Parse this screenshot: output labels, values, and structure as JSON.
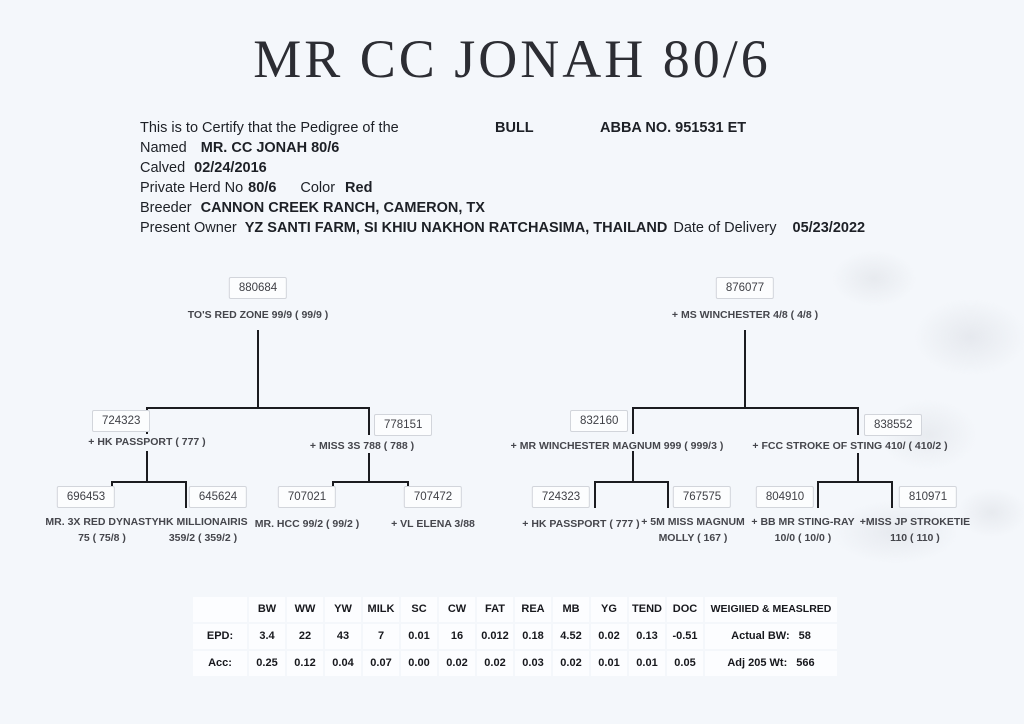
{
  "title": "MR CC JONAH 80/6",
  "certificate": {
    "intro": "This is to Certify that the Pedigree of the",
    "animal_type": "BULL",
    "abba_no": "ABBA NO. 951531 ET",
    "named_label": "Named",
    "named_value": "MR. CC JONAH 80/6",
    "calved_label": "Calved",
    "calved_value": "02/24/2016",
    "herd_label": "Private Herd No",
    "herd_value": "80/6",
    "color_label": "Color",
    "color_value": "Red",
    "breeder_label": "Breeder",
    "breeder_value": "CANNON CREEK RANCH, CAMERON, TX",
    "owner_label": "Present Owner",
    "owner_value": "YZ SANTI FARM, SI KHIU NAKHON RATCHASIMA, THAILAND",
    "delivery_label": "Date of Delivery",
    "delivery_value": "05/23/2022"
  },
  "ped": {
    "s": {
      "reg": "880684",
      "name": "TO'S RED ZONE 99/9 ( 99/9 )"
    },
    "ss": {
      "reg": "724323",
      "name": "+ HK PASSPORT ( 777 )"
    },
    "sd": {
      "reg": "778151",
      "name": "+ MISS 3S 788 ( 788 )"
    },
    "sss": {
      "reg": "696453",
      "name": "MR. 3X RED DYNASTY",
      "name2": "75 ( 75/8 )"
    },
    "ssd": {
      "reg": "645624",
      "name": "HK MILLIONAIRIS",
      "name2": "359/2 ( 359/2 )"
    },
    "sds": {
      "reg": "707021",
      "name": "MR. HCC 99/2 ( 99/2 )"
    },
    "sdd": {
      "reg": "707472",
      "name": "+ VL ELENA 3/88"
    },
    "d": {
      "reg": "876077",
      "name": "+ MS WINCHESTER 4/8 ( 4/8 )"
    },
    "ds": {
      "reg": "832160",
      "name": "+ MR WINCHESTER MAGNUM 999 ( 999/3 )"
    },
    "dd": {
      "reg": "838552",
      "name": "+ FCC STROKE OF STING 410/ ( 410/2 )"
    },
    "dss": {
      "reg": "724323",
      "name": "+ HK PASSPORT ( 777 )"
    },
    "dsd": {
      "reg": "767575",
      "name": "+ 5M MISS MAGNUM",
      "name2": "MOLLY ( 167 )"
    },
    "dds": {
      "reg": "804910",
      "name": "+ BB MR STING-RAY",
      "name2": "10/0 ( 10/0 )"
    },
    "ddd": {
      "reg": "810971",
      "name": "+MISS JP STROKETIE",
      "name2": "110 ( 110 )"
    }
  },
  "epd": {
    "columns": [
      "BW",
      "WW",
      "YW",
      "MILK",
      "SC",
      "CW",
      "FAT",
      "REA",
      "MB",
      "YG",
      "TEND",
      "DOC",
      "WEIGIIED & MEASLRED"
    ],
    "rows": [
      {
        "label": "EPD:",
        "values": [
          "3.4",
          "22",
          "43",
          "7",
          "0.01",
          "16",
          "0.012",
          "0.18",
          "4.52",
          "0.02",
          "0.13",
          "-0.51"
        ],
        "extra_label": "Actual BW:",
        "extra_value": "58"
      },
      {
        "label": "Acc:",
        "values": [
          "0.25",
          "0.12",
          "0.04",
          "0.07",
          "0.00",
          "0.02",
          "0.02",
          "0.03",
          "0.02",
          "0.01",
          "0.01",
          "0.05"
        ],
        "extra_label": "Adj 205 Wt:",
        "extra_value": "566"
      }
    ]
  }
}
